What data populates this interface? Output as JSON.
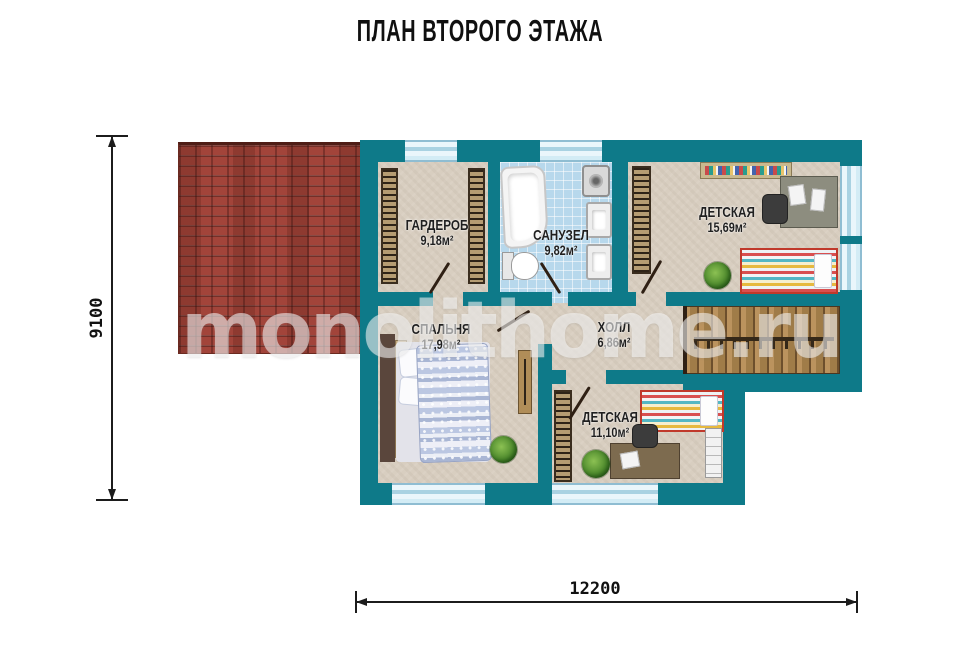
{
  "title": "ПЛАН ВТОРОГО ЭТАЖА",
  "watermark": "monolithome.ru",
  "dimensions": {
    "vertical": "9100",
    "horizontal": "12200"
  },
  "rooms": [
    {
      "id": "wardrobe",
      "name": "ГАРДЕРОБ",
      "area": "9,18м²"
    },
    {
      "id": "bathroom",
      "name": "САНУЗЕЛ",
      "area": "9,82м²"
    },
    {
      "id": "kids-room-1",
      "name": "ДЕТСКАЯ",
      "area": "15,69м²"
    },
    {
      "id": "bedroom",
      "name": "СПАЛЬНЯ",
      "area": "17,98м²"
    },
    {
      "id": "hall",
      "name": "ХОЛЛ",
      "area": "6,86м²"
    },
    {
      "id": "kids-room-2",
      "name": "ДЕТСКАЯ",
      "area": "11,10м²"
    }
  ],
  "colors": {
    "wall": "#0e7a89",
    "floor": "#d8cec0",
    "bathroom_floor": "#b7d8ec",
    "roof": "#a2443a",
    "stairs_wood": "#bb935e",
    "dimension_line": "#1c1c1c"
  }
}
